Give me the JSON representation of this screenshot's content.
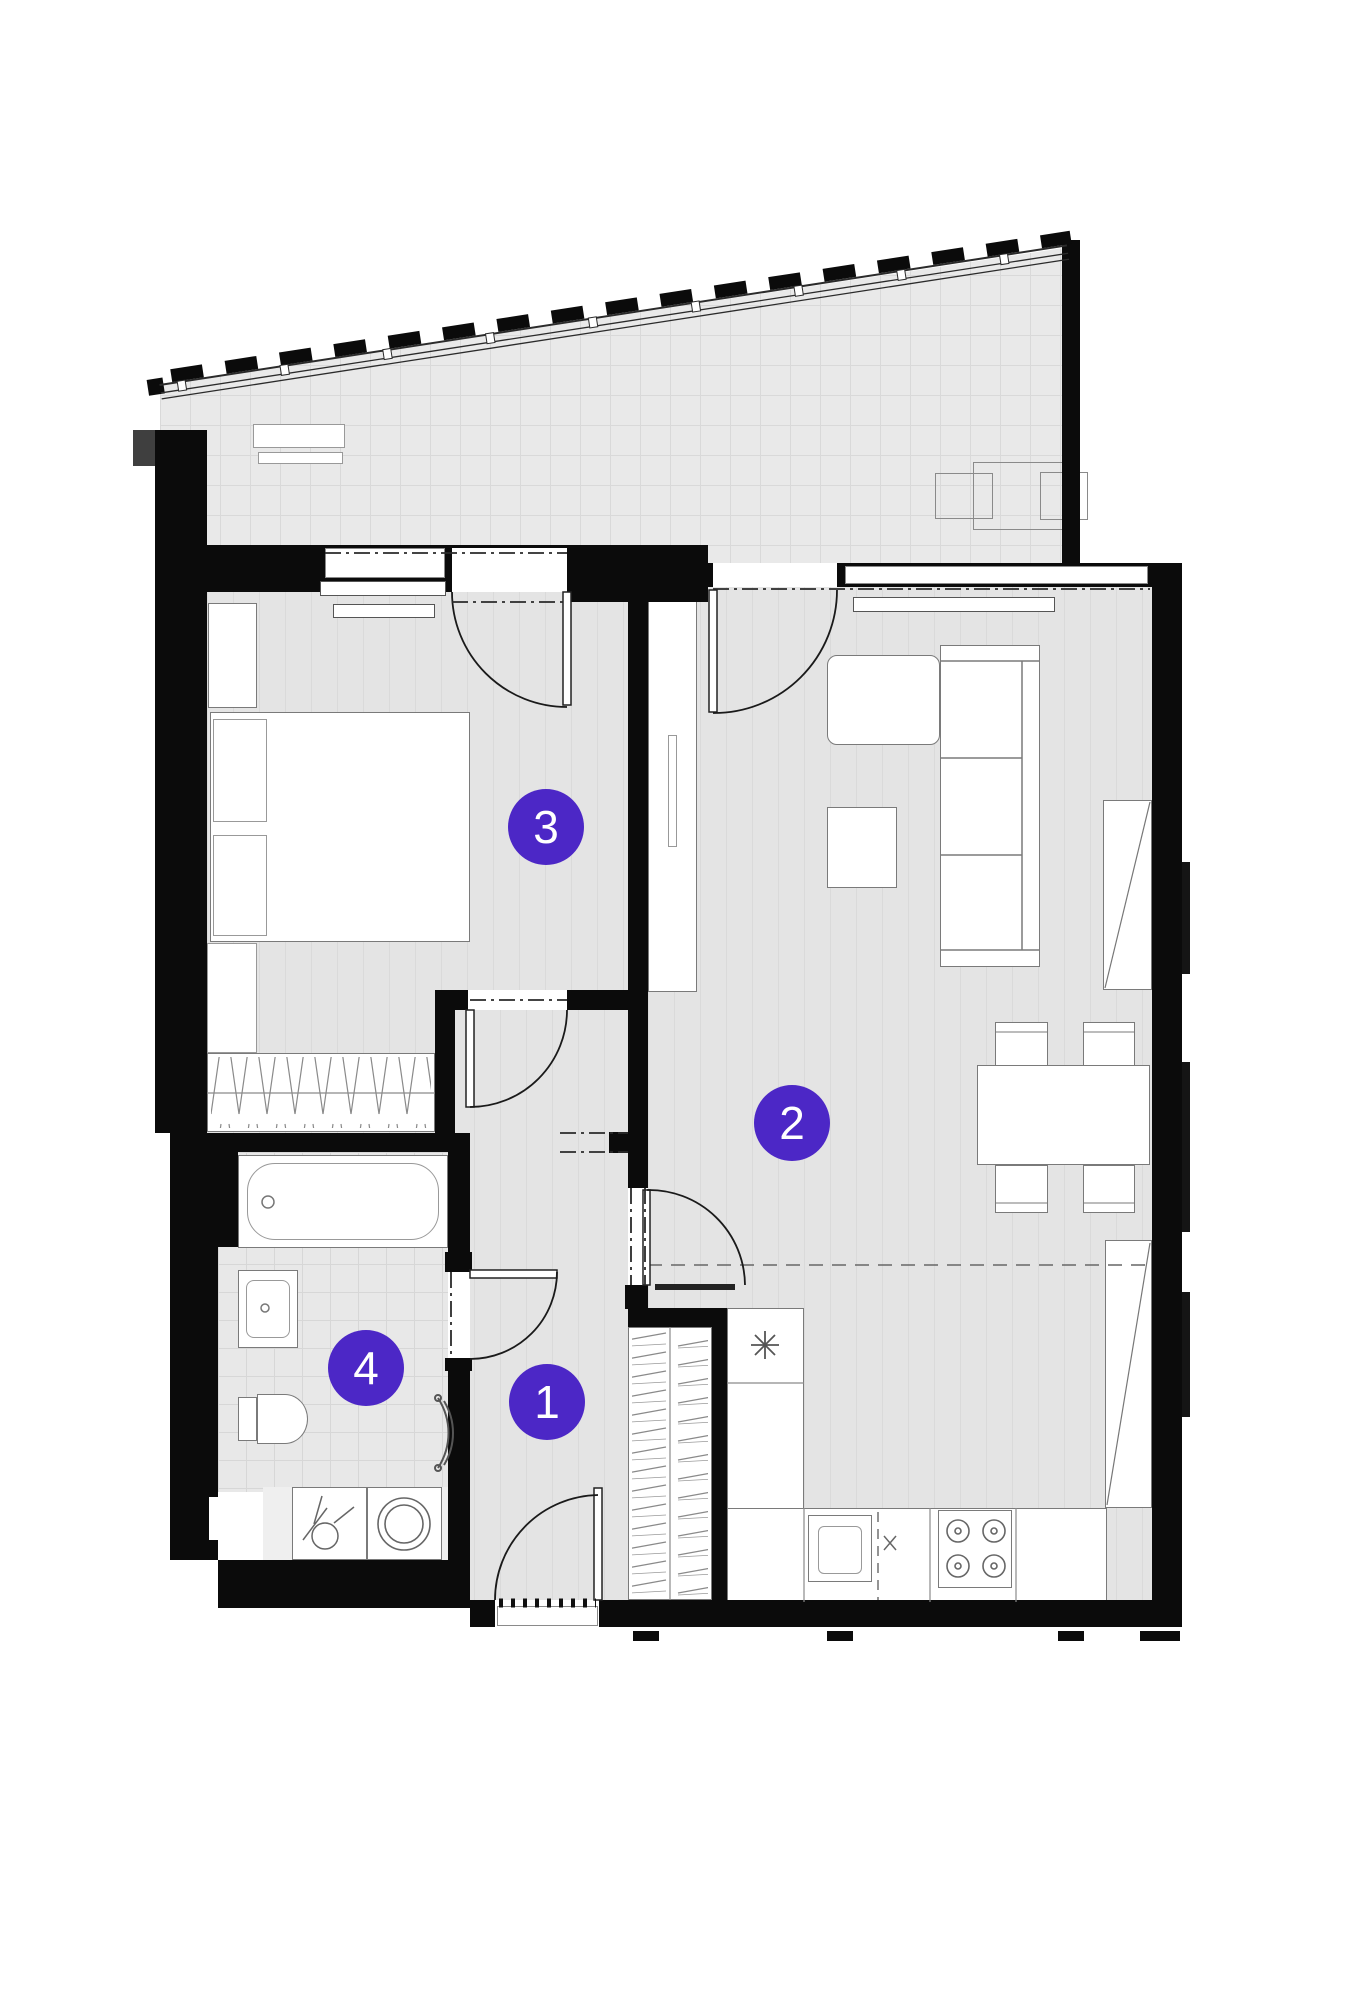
{
  "badges": [
    {
      "number": "1"
    },
    {
      "number": "2"
    },
    {
      "number": "3"
    },
    {
      "number": "4"
    }
  ],
  "colors": {
    "badge": "#4C27C6",
    "wall": "#0b0b0b",
    "floor": "#e4e4e4",
    "balcony_floor": "#e9e9e9",
    "furniture_border": "#7a7a7a"
  }
}
